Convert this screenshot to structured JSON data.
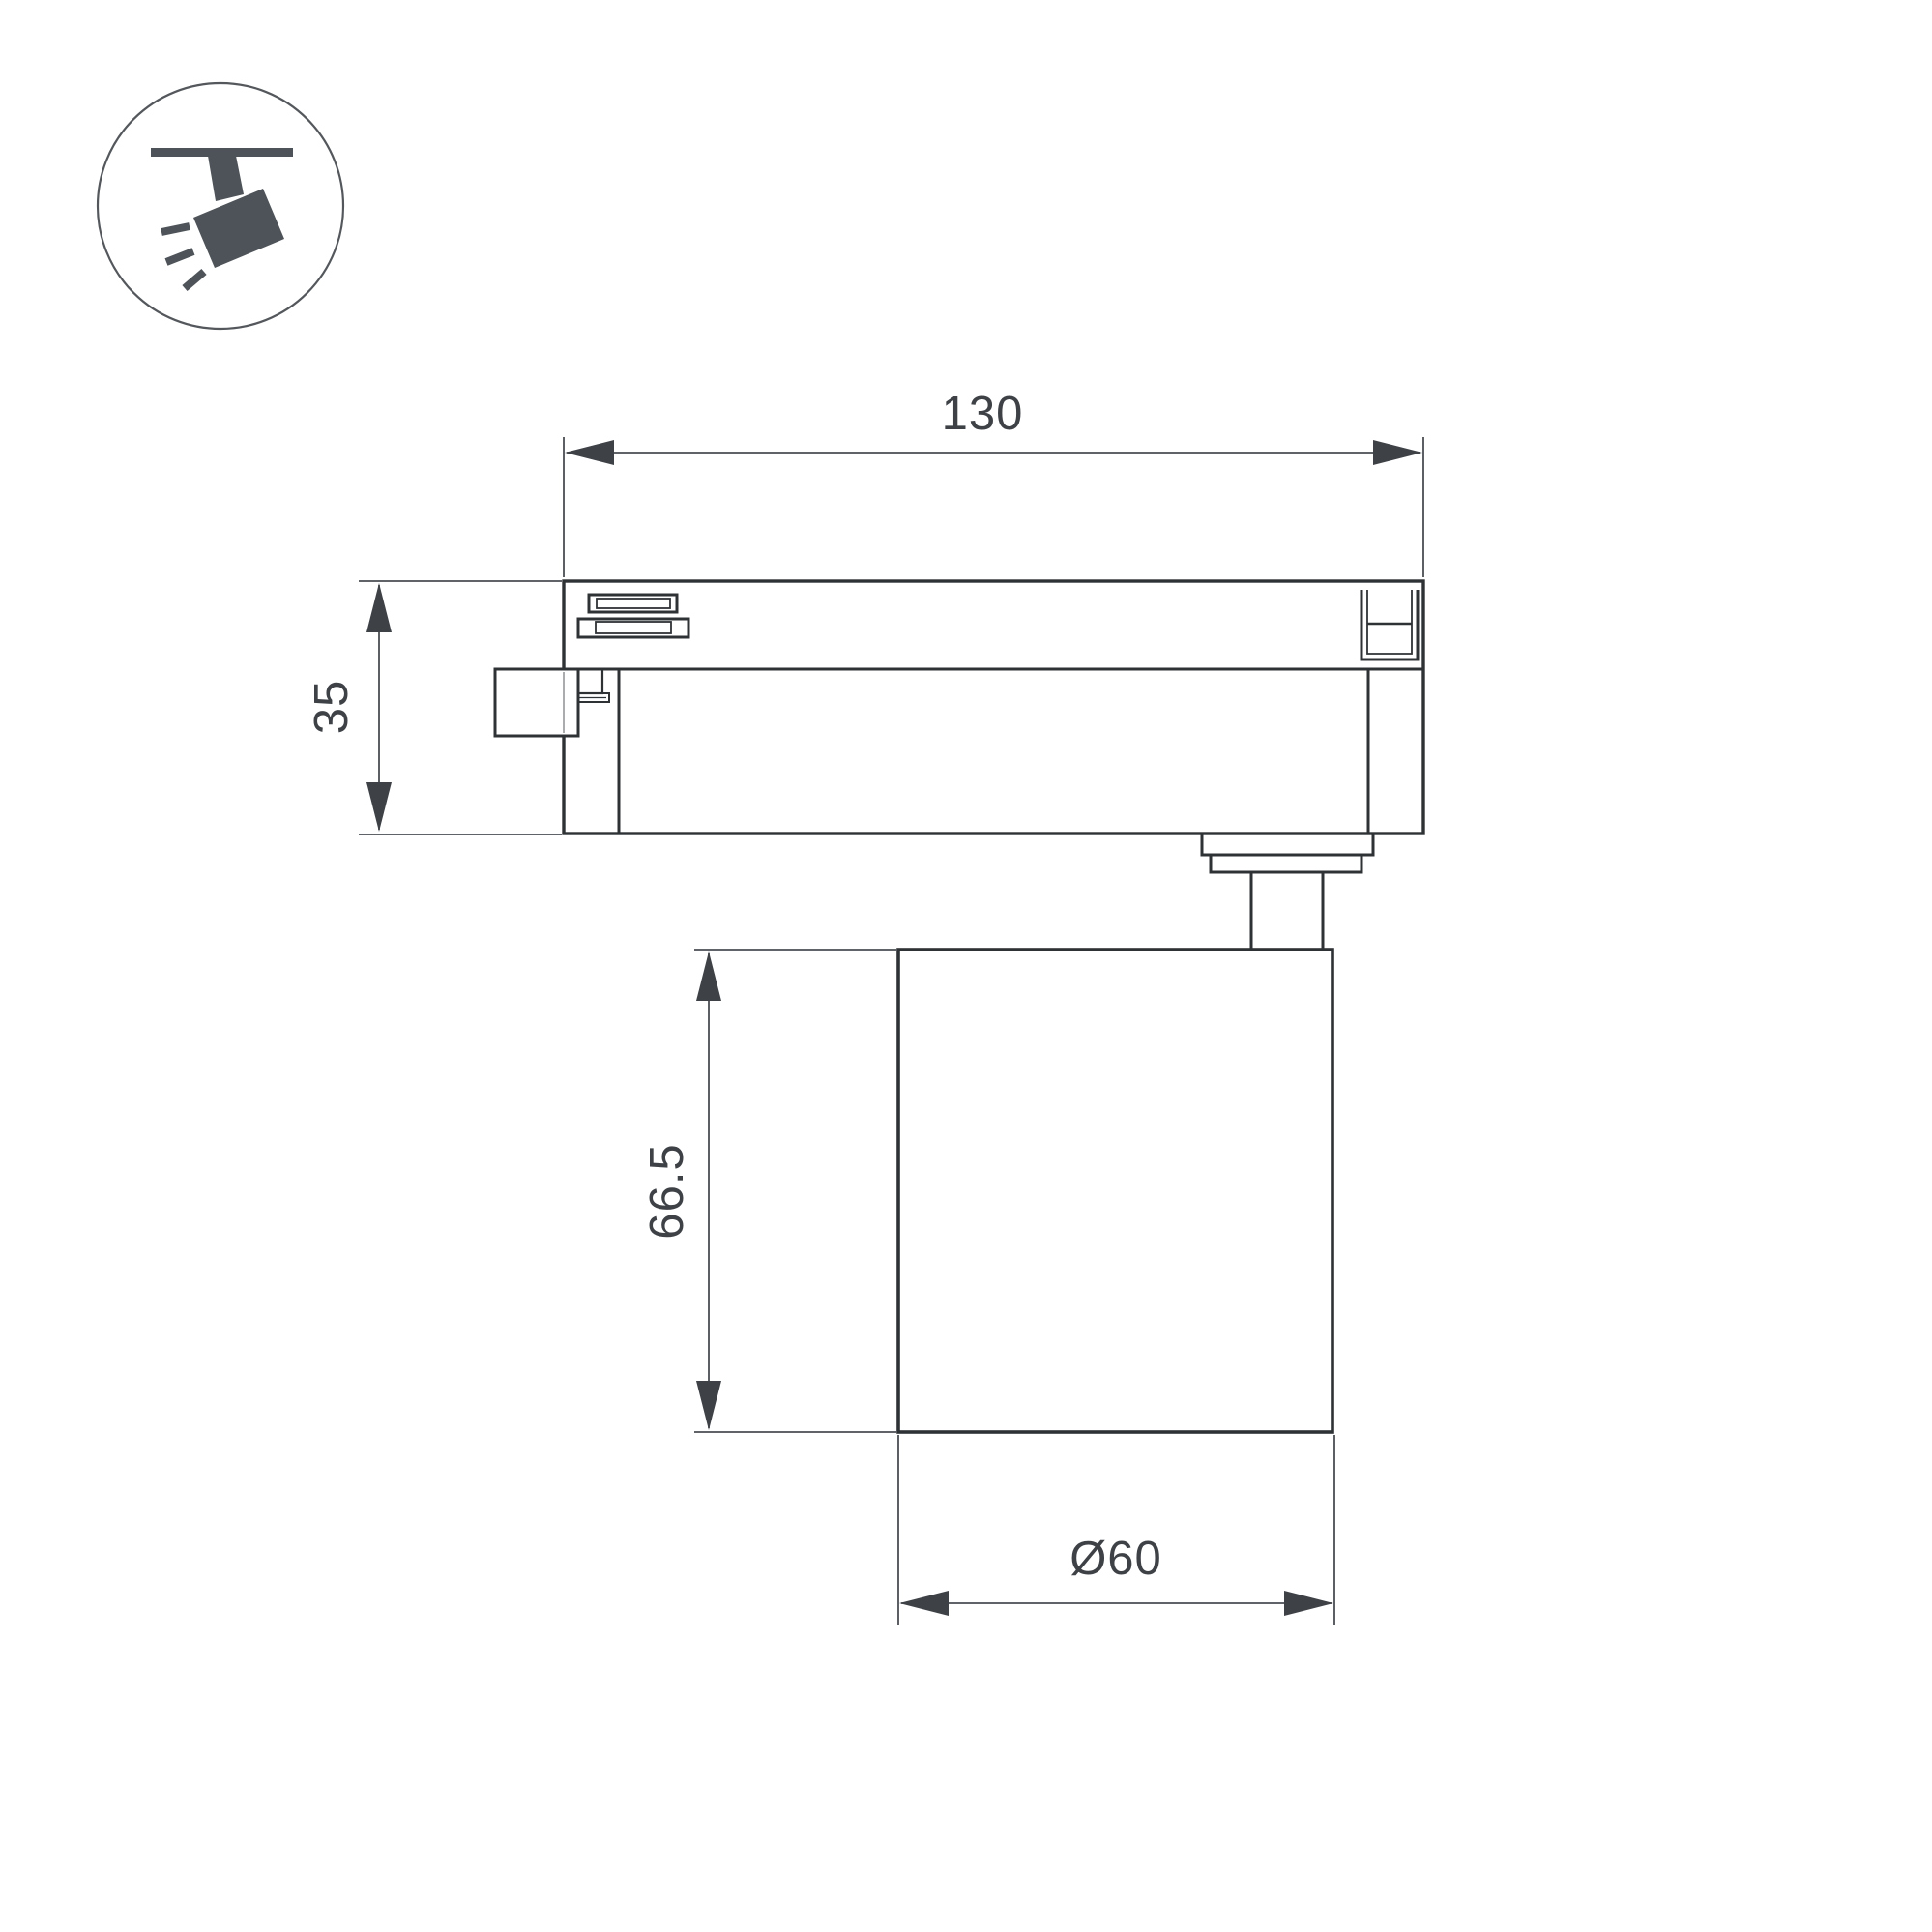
{
  "colors": {
    "body_line": "#2f3235",
    "dimension_line": "#4a4e53",
    "arrow_fill": "#3e4247",
    "text": "#3e4247",
    "icon": "#4d5358",
    "background": "#ffffff"
  },
  "icon": {
    "name": "track-spotlight-icon"
  },
  "drawing": {
    "dimensions": {
      "track_length": {
        "label": "130"
      },
      "track_height": {
        "label": "35"
      },
      "body_height": {
        "label": "66.5"
      },
      "body_diameter": {
        "label": "Ø60"
      }
    }
  }
}
